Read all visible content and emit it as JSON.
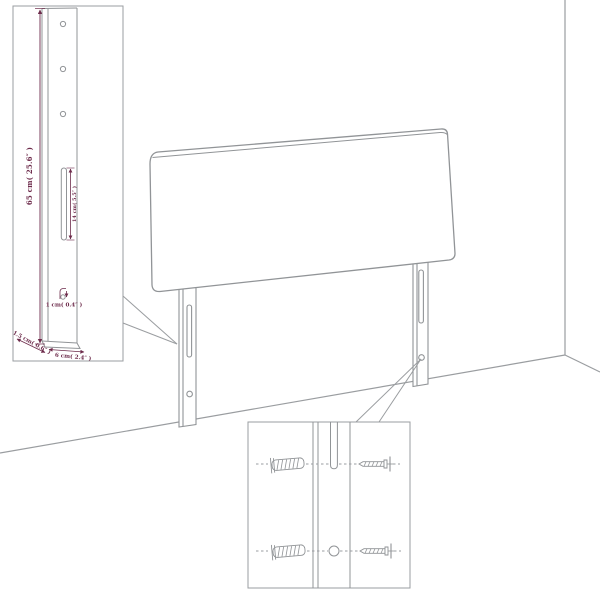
{
  "diagram": {
    "subject": "headboard-assembly-diagram",
    "colors": {
      "line": "#919497",
      "dimension_text": "#6d2b4b",
      "background": "#ffffff"
    }
  },
  "detail_leg": {
    "height_label": "65 cm( 25.6″ )",
    "slot_label": "14 cm( 5.5″ )",
    "hook_label": "1 cm( 0.4″ )",
    "depth_label": "1.5 cm( 0.6″ )",
    "width_label": "6 cm( 2.4″ )"
  }
}
